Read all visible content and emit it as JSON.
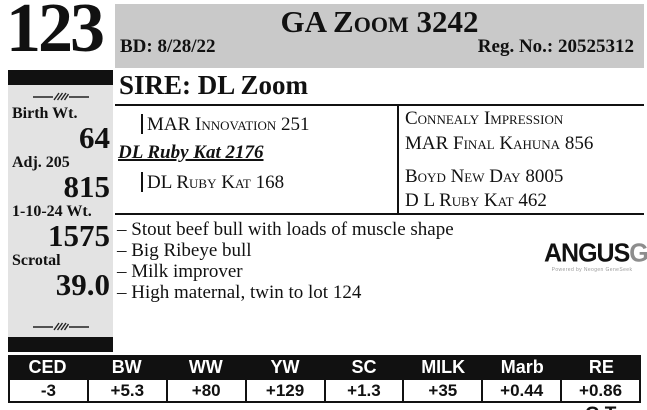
{
  "colors": {
    "band": "#c9c9c9",
    "sidebar": "#e3e3e3",
    "table_header_bg": "#111111"
  },
  "lot": {
    "number": "123"
  },
  "header": {
    "title": "GA Zoom 3242",
    "birth_date": "BD: 8/28/22",
    "registration": "Reg. No.: 20525312"
  },
  "sidebar": {
    "stats": [
      {
        "label": "Birth Wt.",
        "value": "64"
      },
      {
        "label": "Adj. 205",
        "value": "815"
      },
      {
        "label": "1-10-24 Wt.",
        "value": "1575"
      },
      {
        "label": "Scrotal",
        "value": "39.0"
      }
    ]
  },
  "sire": {
    "heading": "SIRE: DL Zoom"
  },
  "pedigree": {
    "dam_sire": "MAR Innovation 251",
    "dam": "DL Ruby Kat 2176",
    "dam_dam": "DL Ruby Kat 168",
    "ancestors": [
      "Connealy Impression",
      "MAR Final Kahuna 856",
      "Boyd New Day 8005",
      "D L Ruby Kat 462"
    ]
  },
  "notes": {
    "items": [
      "– Stout beef bull with loads of muscle shape",
      "– Big Ribeye bull",
      "– Milk improver",
      "– High maternal, twin to lot 124"
    ]
  },
  "logo": {
    "angus": "ANGUS",
    "gs": "GS",
    "tagline": "Powered by Neogen GeneSeek"
  },
  "epd": {
    "columns": [
      "CED",
      "BW",
      "WW",
      "YW",
      "SC",
      "MILK",
      "Marb",
      "RE"
    ],
    "values": [
      "-3",
      "+5.3",
      "+80",
      "+129",
      "+1.3",
      "+35",
      "+0.44",
      "+0.86"
    ]
  },
  "footer": {
    "partial_mark": "GT"
  }
}
